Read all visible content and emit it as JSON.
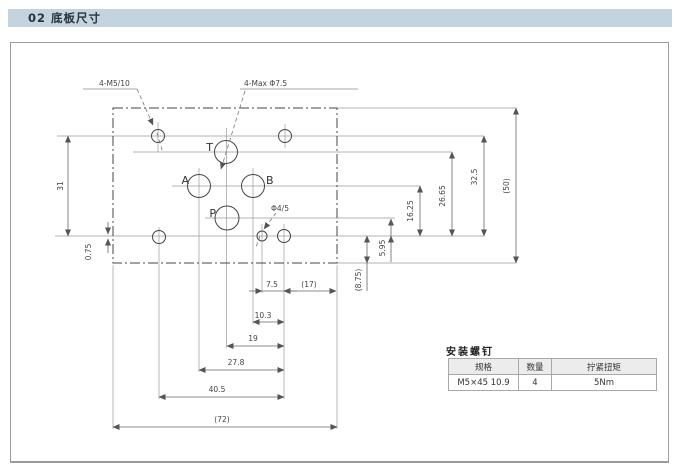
{
  "header": {
    "title": "02 底板尺寸"
  },
  "drawing": {
    "labels": {
      "fixing_holes": "4-M5/10",
      "ports_max": "4-Max Φ7.5",
      "pin_hole": "Φ4/5",
      "port_t": "T",
      "port_a": "A",
      "port_b": "B",
      "port_p": "P"
    },
    "dims": {
      "fixing_spacing_left": "31",
      "fixing_offset": "0.75",
      "p_height": "5.95",
      "ab_height": "16.25",
      "t_height": "26.65",
      "fixing_spacing_right": "32.5",
      "plate_height": "(50)",
      "edge_below": "(8.75)",
      "pin_to_fixing": "7.5",
      "fixing_to_edge": "(17)",
      "b_to_fixing": "10.3",
      "p_to_fixing": "19",
      "a_to_fixing": "27.8",
      "fixing_spacing_h": "40.5",
      "plate_width": "(72)"
    }
  },
  "table": {
    "title": "安装螺钉",
    "headers": [
      "规格",
      "数量",
      "拧紧扭矩"
    ],
    "rows": [
      [
        "M5×45 10.9",
        "4",
        "5Nm"
      ]
    ]
  },
  "colors": {
    "title_bar_bg": "#c3d4de",
    "line": "#555555",
    "panel_border": "#9b9b9b"
  }
}
